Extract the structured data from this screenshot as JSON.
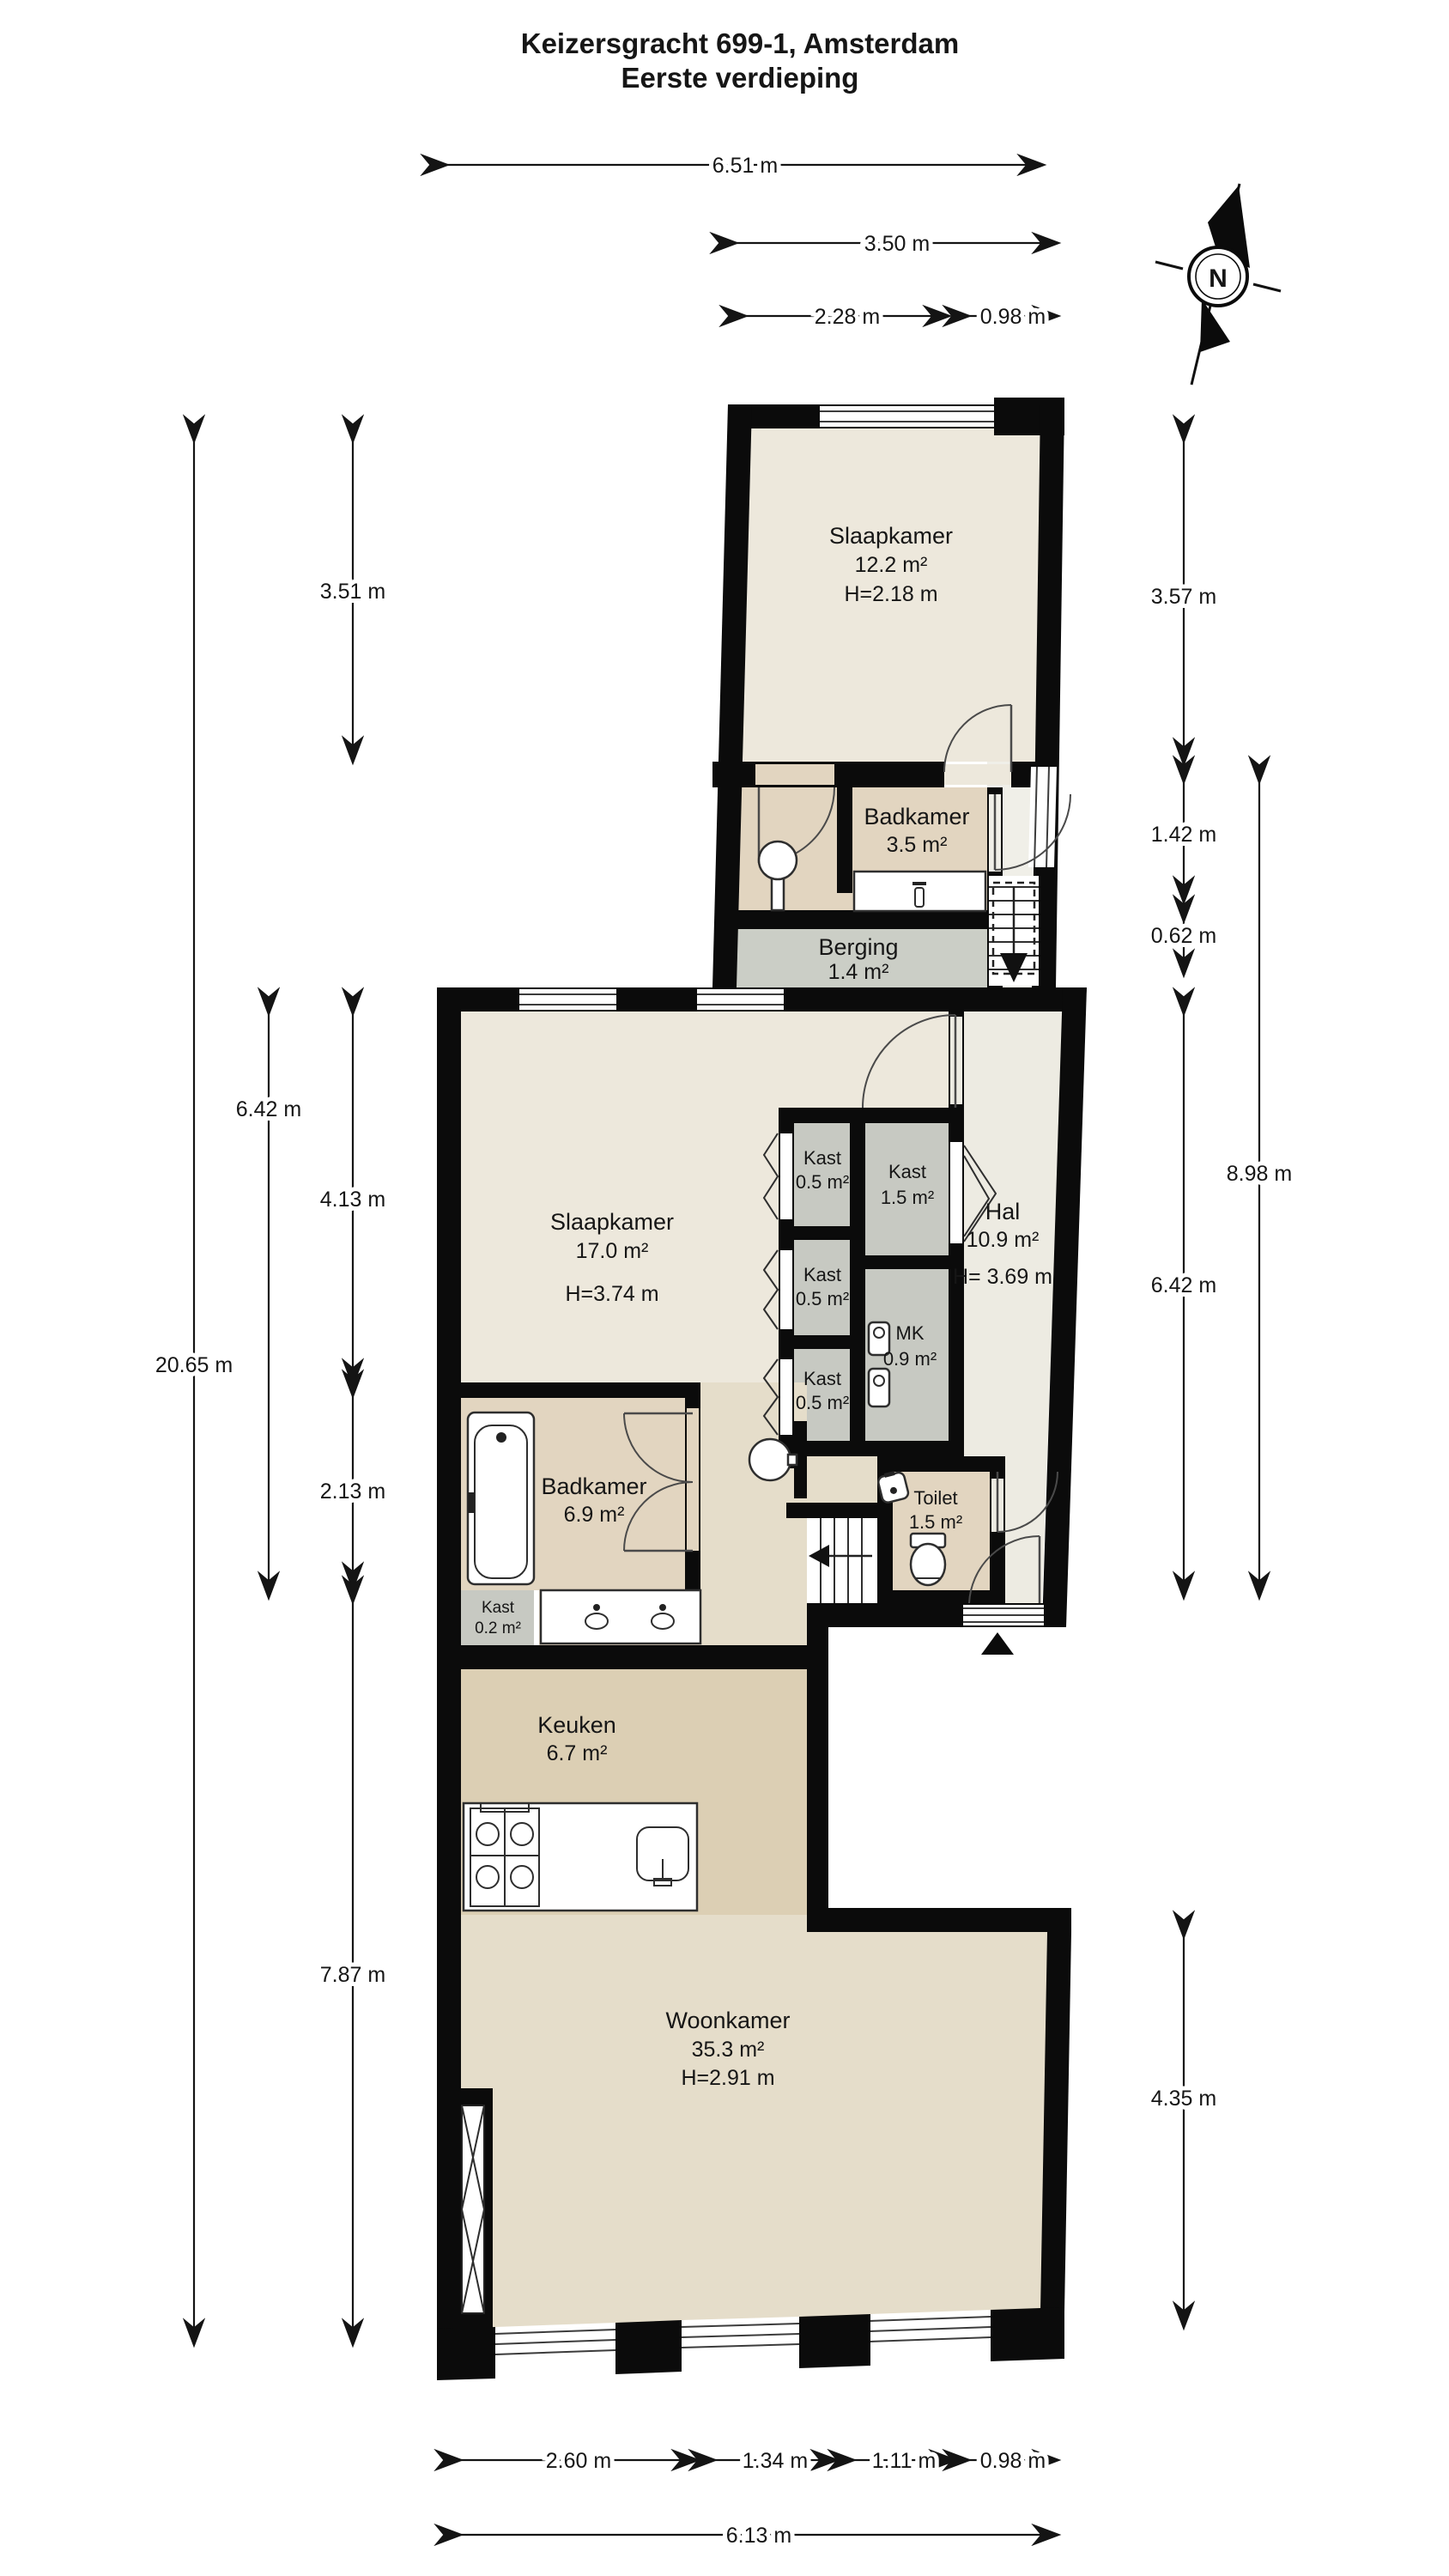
{
  "title": {
    "line1": "Keizersgracht 699-1, Amsterdam",
    "line2": "Eerste verdieping"
  },
  "compass": {
    "label": "N"
  },
  "rooms": {
    "slaapkamer_boven": {
      "name": "Slaapkamer",
      "area": "12.2 m²",
      "height": "H=2.18 m"
    },
    "badkamer_boven": {
      "name": "Badkamer",
      "area": "3.5 m²"
    },
    "berging": {
      "name": "Berging",
      "area": "1.4 m²"
    },
    "slaapkamer": {
      "name": "Slaapkamer",
      "area": "17.0 m²",
      "height": "H=3.74 m"
    },
    "kast_1": {
      "name": "Kast",
      "area": "0.5 m²"
    },
    "kast_2": {
      "name": "Kast",
      "area": "0.5 m²"
    },
    "kast_3": {
      "name": "Kast",
      "area": "0.5 m²"
    },
    "kast_groot": {
      "name": "Kast",
      "area": "1.5 m²"
    },
    "mk": {
      "name": "MK",
      "area": "0.9 m²"
    },
    "hal": {
      "name": "Hal",
      "area": "10.9 m²",
      "height": "H= 3.69 m"
    },
    "toilet": {
      "name": "Toilet",
      "area": "1.5 m²"
    },
    "badkamer": {
      "name": "Badkamer",
      "area": "6.9 m²"
    },
    "kast_klein": {
      "name": "Kast",
      "area": "0.2 m²"
    },
    "keuken": {
      "name": "Keuken",
      "area": "6.7 m²"
    },
    "woonkamer": {
      "name": "Woonkamer",
      "area": "35.3 m²",
      "height": "H=2.91 m"
    }
  },
  "dimensions": {
    "top": {
      "total": "6.51 m",
      "upper_block": "3.50 m",
      "window": "2.28 m",
      "stair_bay": "0.98 m"
    },
    "left": {
      "upper": "3.51 m",
      "middle_upper": "4.13 m",
      "middle_total": "6.42 m",
      "building_total": "20.65 m",
      "bathroom": "2.13 m",
      "lower": "7.87 m"
    },
    "right": {
      "upper": "3.57 m",
      "bathroom": "1.42 m",
      "storage": "0.62 m",
      "outer_total": "8.98 m",
      "middle_total": "6.42 m",
      "living": "4.35 m"
    },
    "bottom": {
      "seg1": "2.60 m",
      "seg2": "1.34 m",
      "seg3": "1.11 m",
      "seg4": "0.98 m",
      "total": "6.13 m"
    }
  },
  "colors": {
    "wall": "#0b0b0b",
    "bedroom_floor": "#EDE8DC",
    "hall_floor": "#EDEBE2",
    "bathroom_floor": "#E2D5C0",
    "closet_floor": "#C7C9C2",
    "berging_floor": "#CBCEC6",
    "kitchen_floor": "#DCCFB4",
    "living_floor": "#E5DDCA"
  }
}
